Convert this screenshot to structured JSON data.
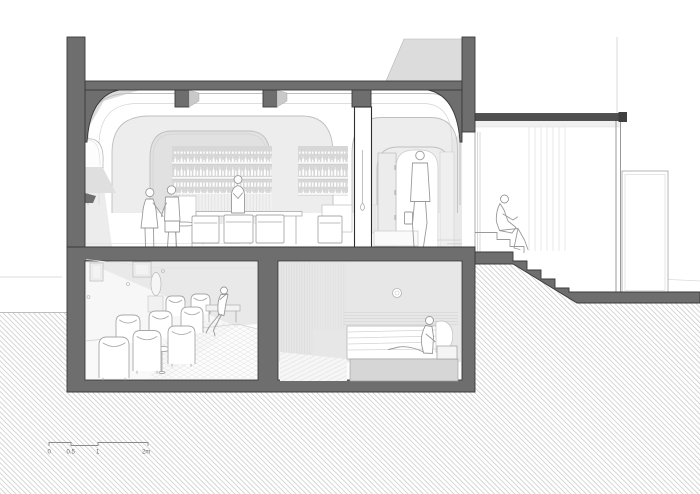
{
  "scale_bar": {
    "labels": [
      "0",
      "0.5",
      "1",
      "2m"
    ]
  },
  "colors": {
    "poche": "#6e6e6e",
    "poche_outline": "#3a3a3a",
    "hatch_line": "#c9c9c9",
    "figure_line": "#9a9a9a",
    "roof_slab": "#4f4f4f",
    "detail_line": "#bfbfbf",
    "shadow_light": "#e7e7e7",
    "background": "#ffffff"
  }
}
